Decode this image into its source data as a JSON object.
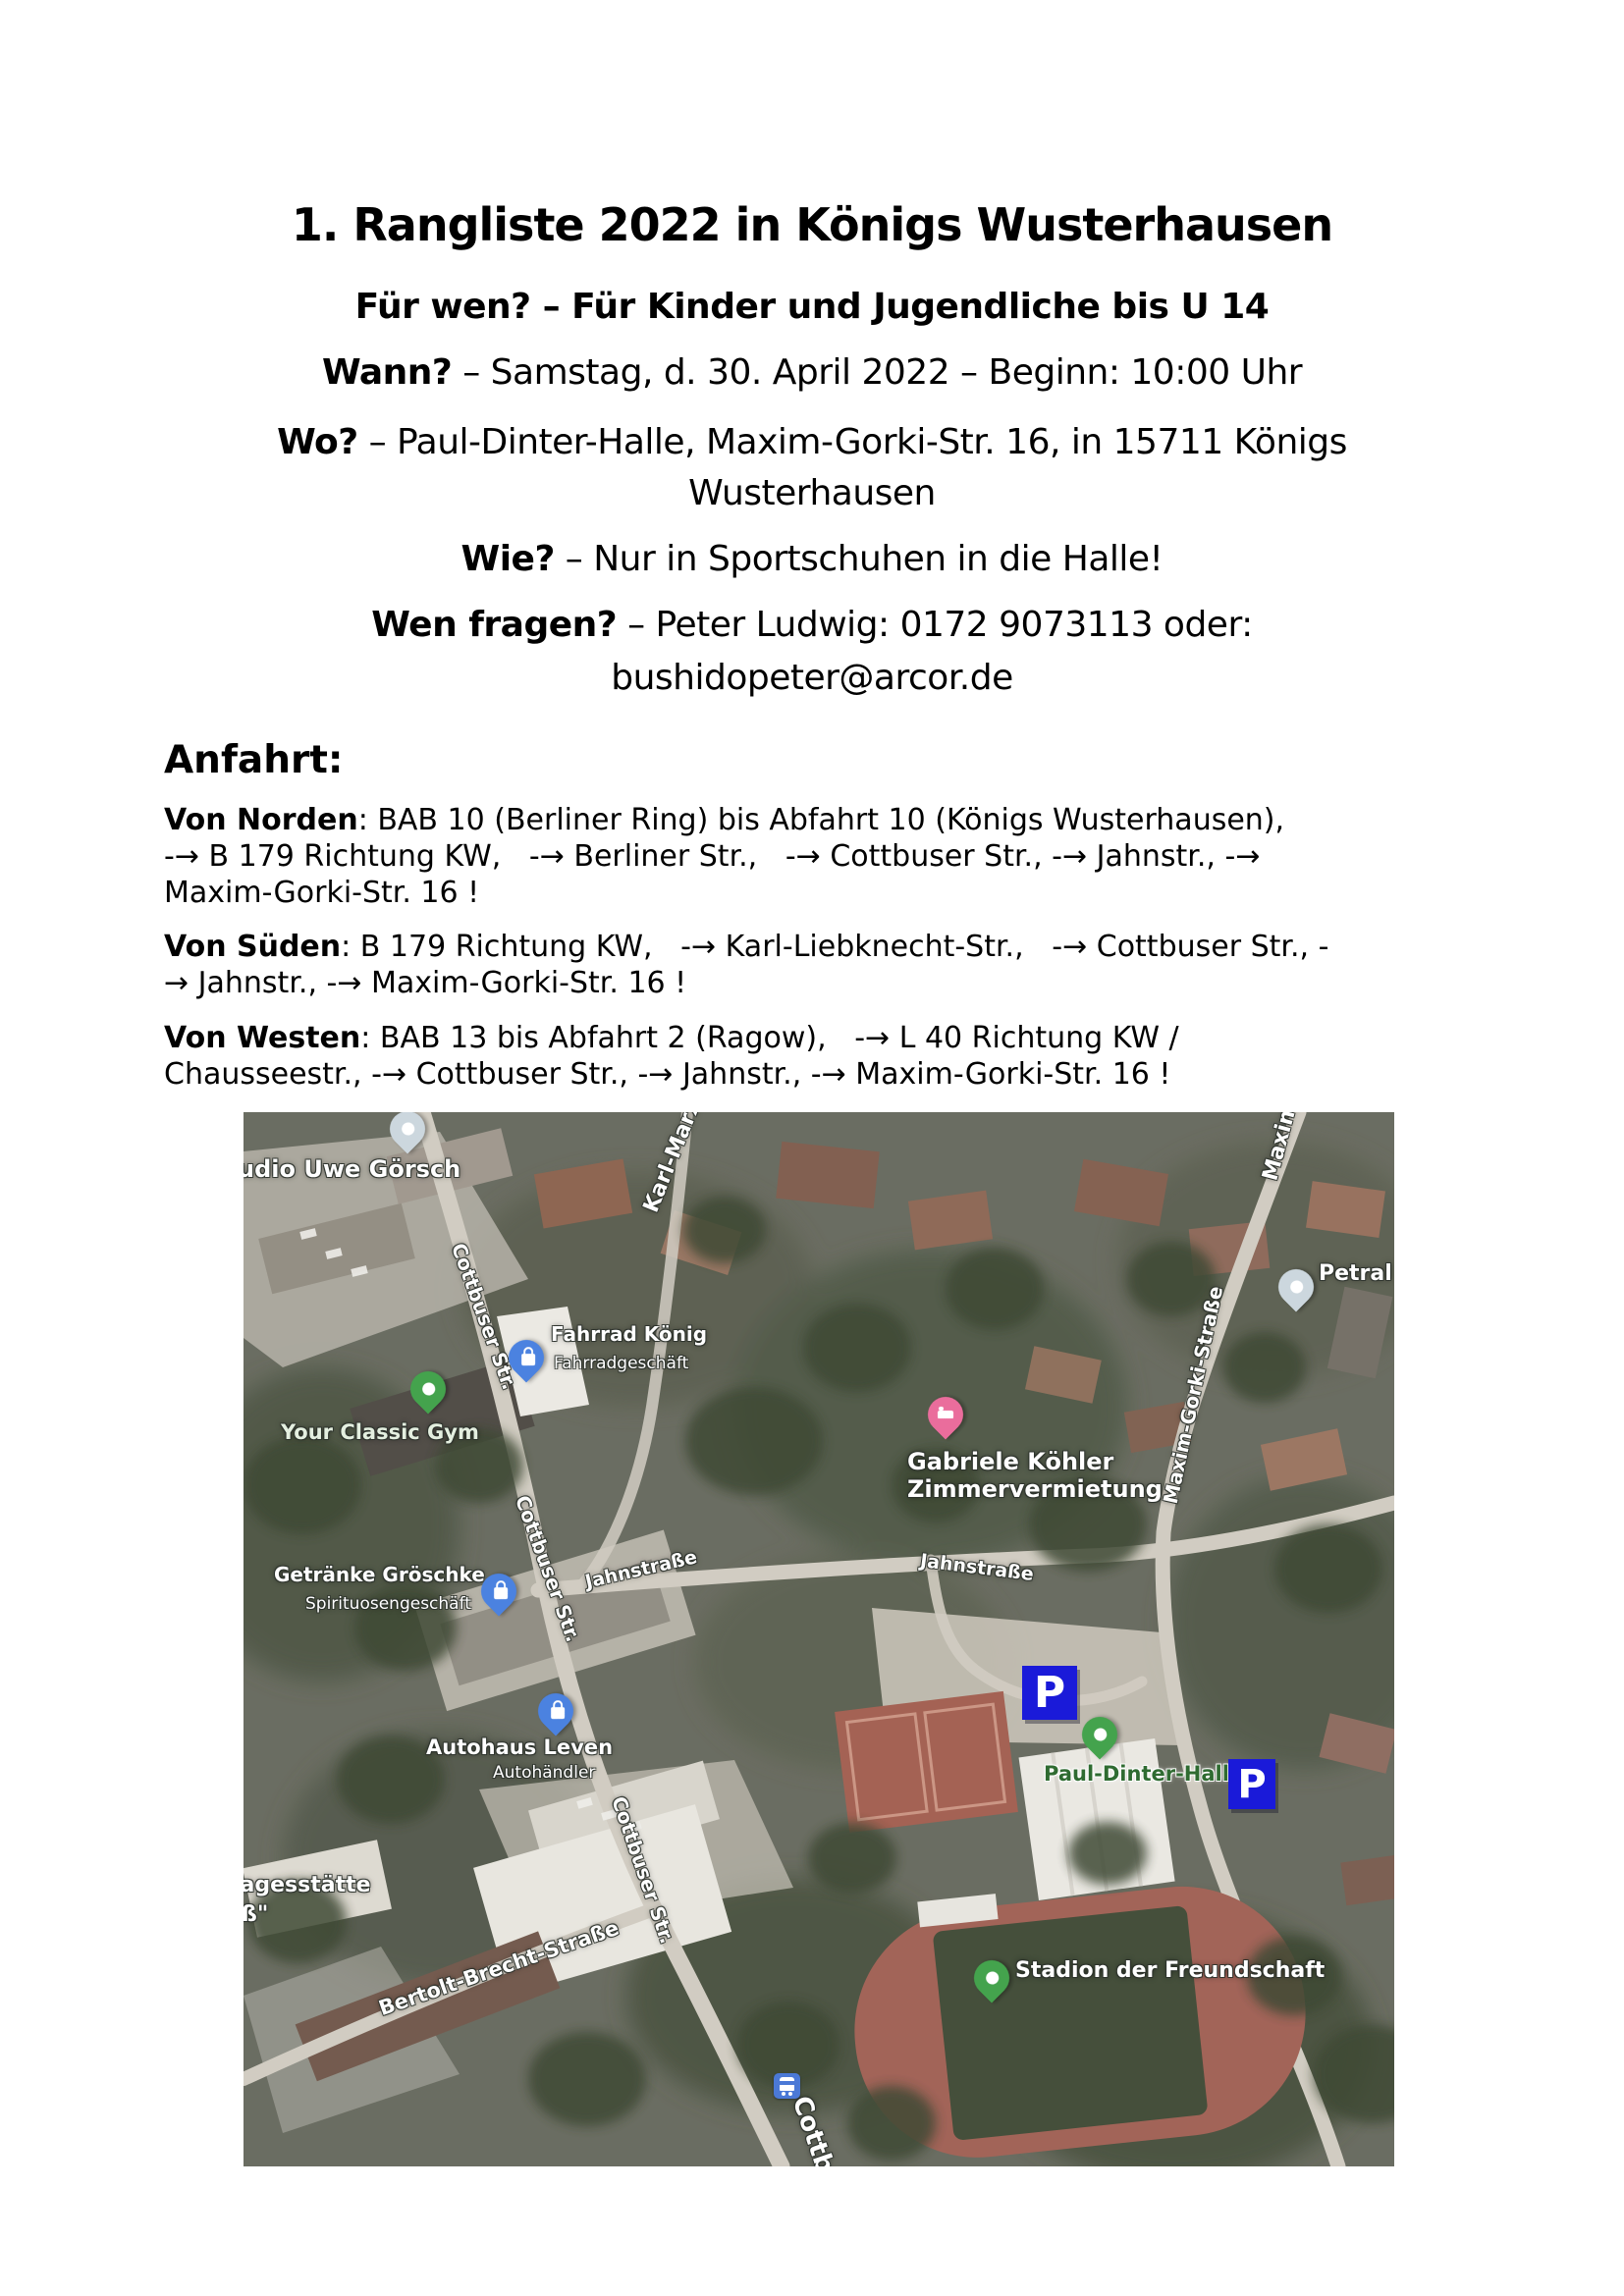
{
  "document": {
    "title": "1. Rangliste 2022 in Königs Wusterhausen",
    "subtitle": "Für wen? – Für Kinder und Jugendliche bis U 14",
    "wann": {
      "label": "Wann?",
      "text": " – Samstag, d. 30. April 2022 – Beginn: 10:00 Uhr"
    },
    "wo": {
      "label": "Wo?",
      "text": " – Paul-Dinter-Halle, Maxim-Gorki-Str. 16, in 15711 Königs",
      "line2": "Wusterhausen"
    },
    "wie": {
      "label": "Wie?",
      "text": " – Nur in Sportschuhen in die Halle!"
    },
    "wen": {
      "label": "Wen fragen?",
      "text": " – Peter Ludwig: 0172 9073113 oder:",
      "line2": "bushidopeter@arcor.de"
    },
    "anfahrt_heading": "Anfahrt:",
    "von_norden": {
      "label": "Von Norden",
      "line1": ": BAB 10 (Berliner Ring) bis Abfahrt 10 (Königs Wusterhausen),",
      "line2": "-→ B 179 Richtung KW,   -→ Berliner Str.,   -→ Cottbuser Str., -→ Jahnstr., -→",
      "line3": "Maxim-Gorki-Str. 16 !"
    },
    "von_sueden": {
      "label": "Von Süden",
      "line1": ": B 179 Richtung KW,   -→ Karl-Liebknecht-Str.,   -→ Cottbuser Str., -",
      "line2": "→ Jahnstr., -→ Maxim-Gorki-Str. 16 !"
    },
    "von_westen": {
      "label": "Von Westen",
      "line1": ": BAB 13 bis Abfahrt 2 (Ragow),   -→ L 40 Richtung KW /",
      "line2": "Chausseestr., -→ Cottbuser Str., -→ Jahnstr., -→ Maxim-Gorki-Str. 16 !"
    }
  },
  "map": {
    "parking_label": "P",
    "street_labels": {
      "karl_marx": "Karl-Marx",
      "maxim_partial": "Maxim",
      "maxim_gorki": "Maxim-Gorki-Straße",
      "cottbuser_1": "Cottbuser Str.",
      "cottbuser_2": "Cottbuser Str.",
      "cottbuser_3": "Cottbuser Str.",
      "cottbuser_4": "Cottbuser Str.",
      "jahnstrasse_1": "Jahnstraße",
      "jahnstrasse_2": "Jahnstraße",
      "bertolt_brecht": "Bertolt-Brecht-Straße"
    },
    "place_labels": {
      "studio_partial": "udio Uwe Görsch",
      "your_classic_gym": "Your Classic Gym",
      "fahrrad_koenig": {
        "title": "Fahrrad König",
        "subtitle": "Fahrradgeschäft"
      },
      "gabriele": {
        "line1": "Gabriele Köhler",
        "line2": "Zimmervermietung"
      },
      "petral": "Petral",
      "getraenke": {
        "title": "Getränke Gröschke",
        "subtitle": "Spirituosengeschäft"
      },
      "autohaus": {
        "title": "Autohaus Leven",
        "subtitle": "Autohändler"
      },
      "paul_dinter": "Paul-Dinter-Halle",
      "stadion": "Stadion der Freundschaft",
      "kita_partial_1": "tagesstätte",
      "kita_partial_2": "ß\""
    },
    "icons": {
      "pin_gray": "place-pin-gray",
      "pin_blue": "shopping-pin-blue",
      "pin_green": "place-pin-green",
      "pin_pink": "lodging-pin-pink",
      "parking": "parking-icon",
      "bus": "bus-stop-icon"
    },
    "colors": {
      "parking_blue": "#1a1ad9",
      "pin_blue": "#4b82e0",
      "pin_green": "#44a34d",
      "pin_pink": "#ea6d9c",
      "pin_gray": "#ccd7de",
      "bus_blue": "#4b79d6",
      "paul_dinter_text": "#2f6b31",
      "street_label_text": "#ffffff"
    }
  }
}
